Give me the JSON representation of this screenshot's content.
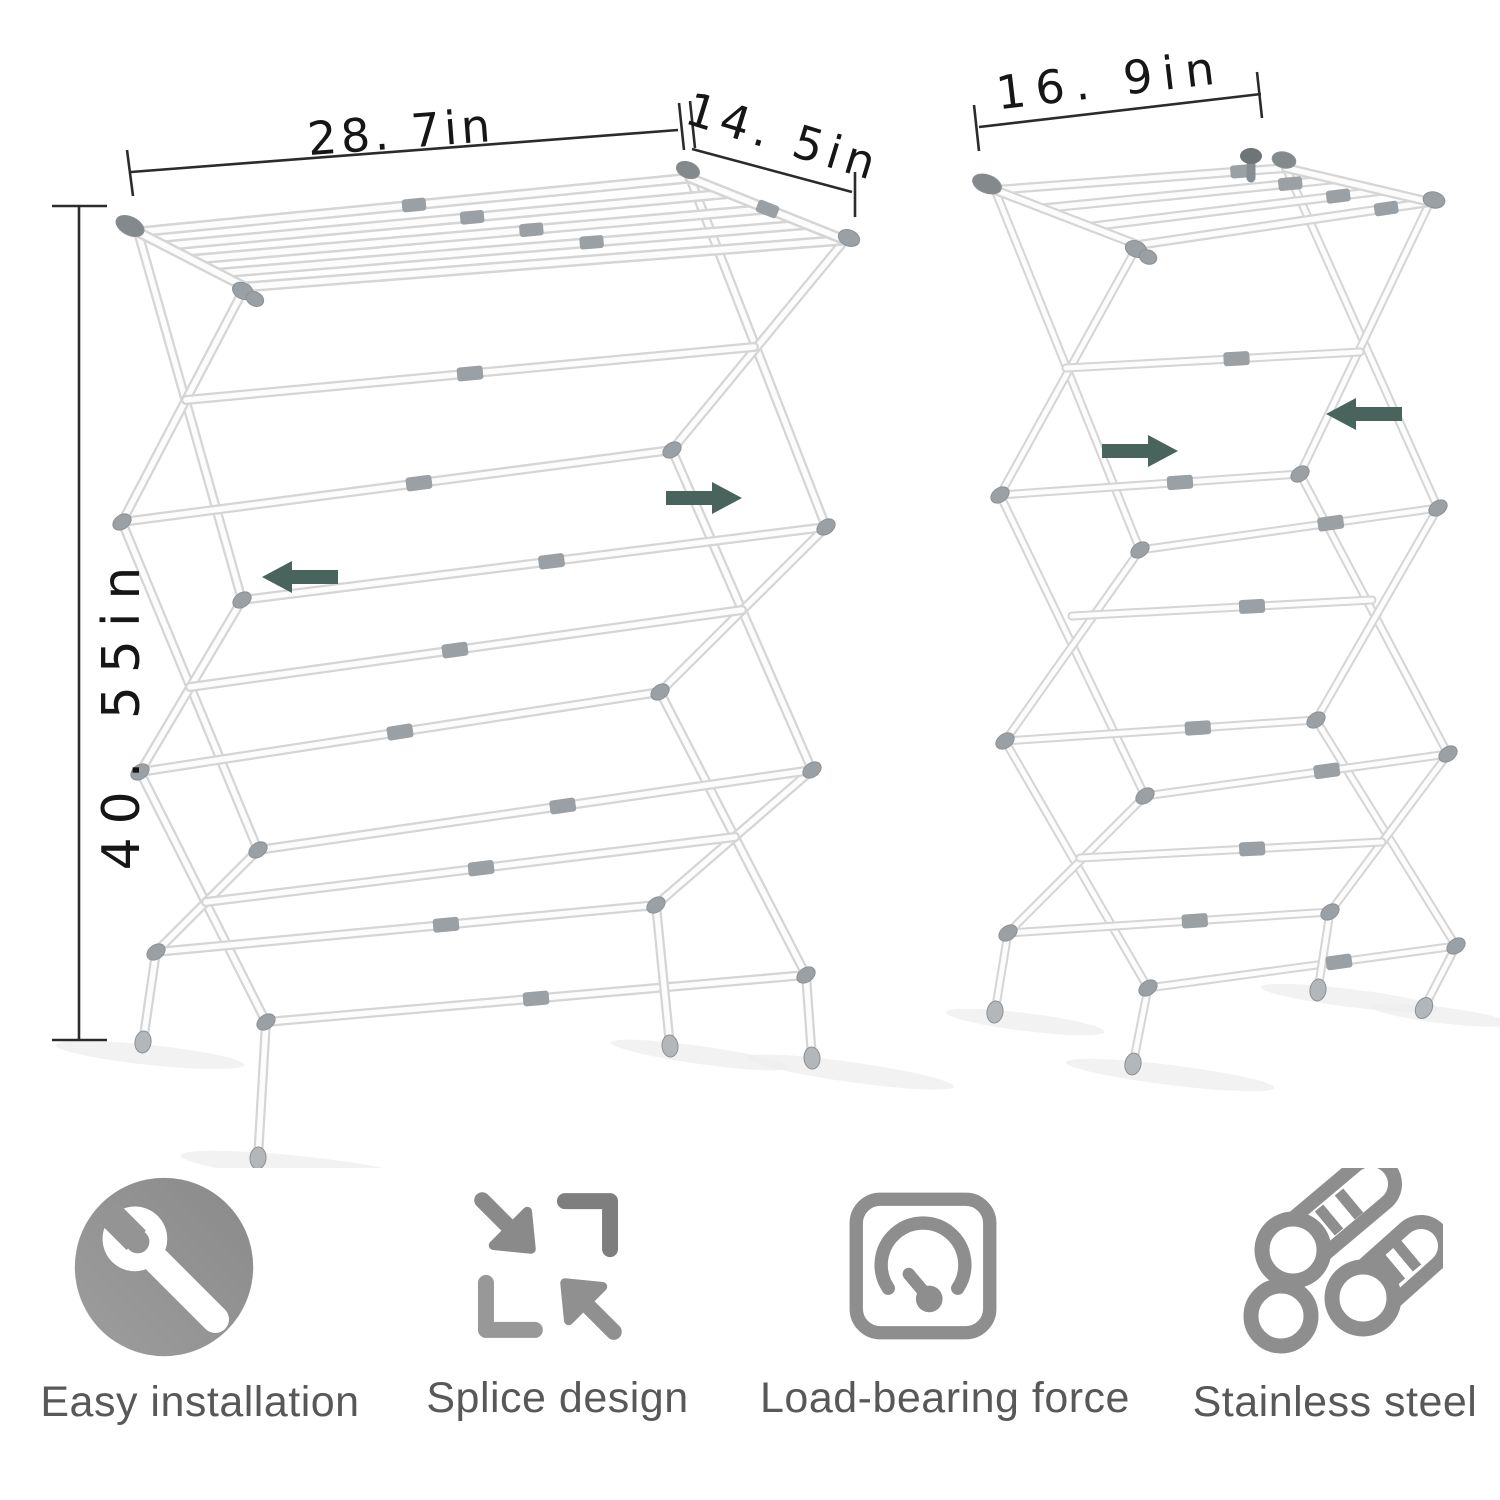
{
  "dimensions": {
    "expanded_width": "28. 7in",
    "depth": "14. 5in",
    "height": "40. 55in",
    "folded_width": "16. 9in"
  },
  "racks": {
    "expanded_name": "drying-rack-expanded",
    "folded_name": "drying-rack-folded"
  },
  "features": [
    {
      "id": "easy-installation",
      "icon": "wrench-icon",
      "label": "Easy installation"
    },
    {
      "id": "splice-design",
      "icon": "expand-arrows-icon",
      "label": "Splice design"
    },
    {
      "id": "load-bearing-force",
      "icon": "gauge-icon",
      "label": "Load-bearing force"
    },
    {
      "id": "stainless-steel",
      "icon": "steel-pipes-icon",
      "label": "Stainless steel"
    }
  ],
  "colors": {
    "background": "#ffffff",
    "arrow": "#48645c",
    "dimension_line": "#2b2b2b",
    "dimension_text": "#161616",
    "tube_edge": "#d5d5d5",
    "tube_fill": "#fcfcfc",
    "hardware": "#9aa0a4",
    "hardware_dark": "#84898c",
    "foot": "#b3b7b9",
    "icon_gray": "#8f8f8f",
    "label_text": "#585858",
    "shadow": "#ededed"
  }
}
